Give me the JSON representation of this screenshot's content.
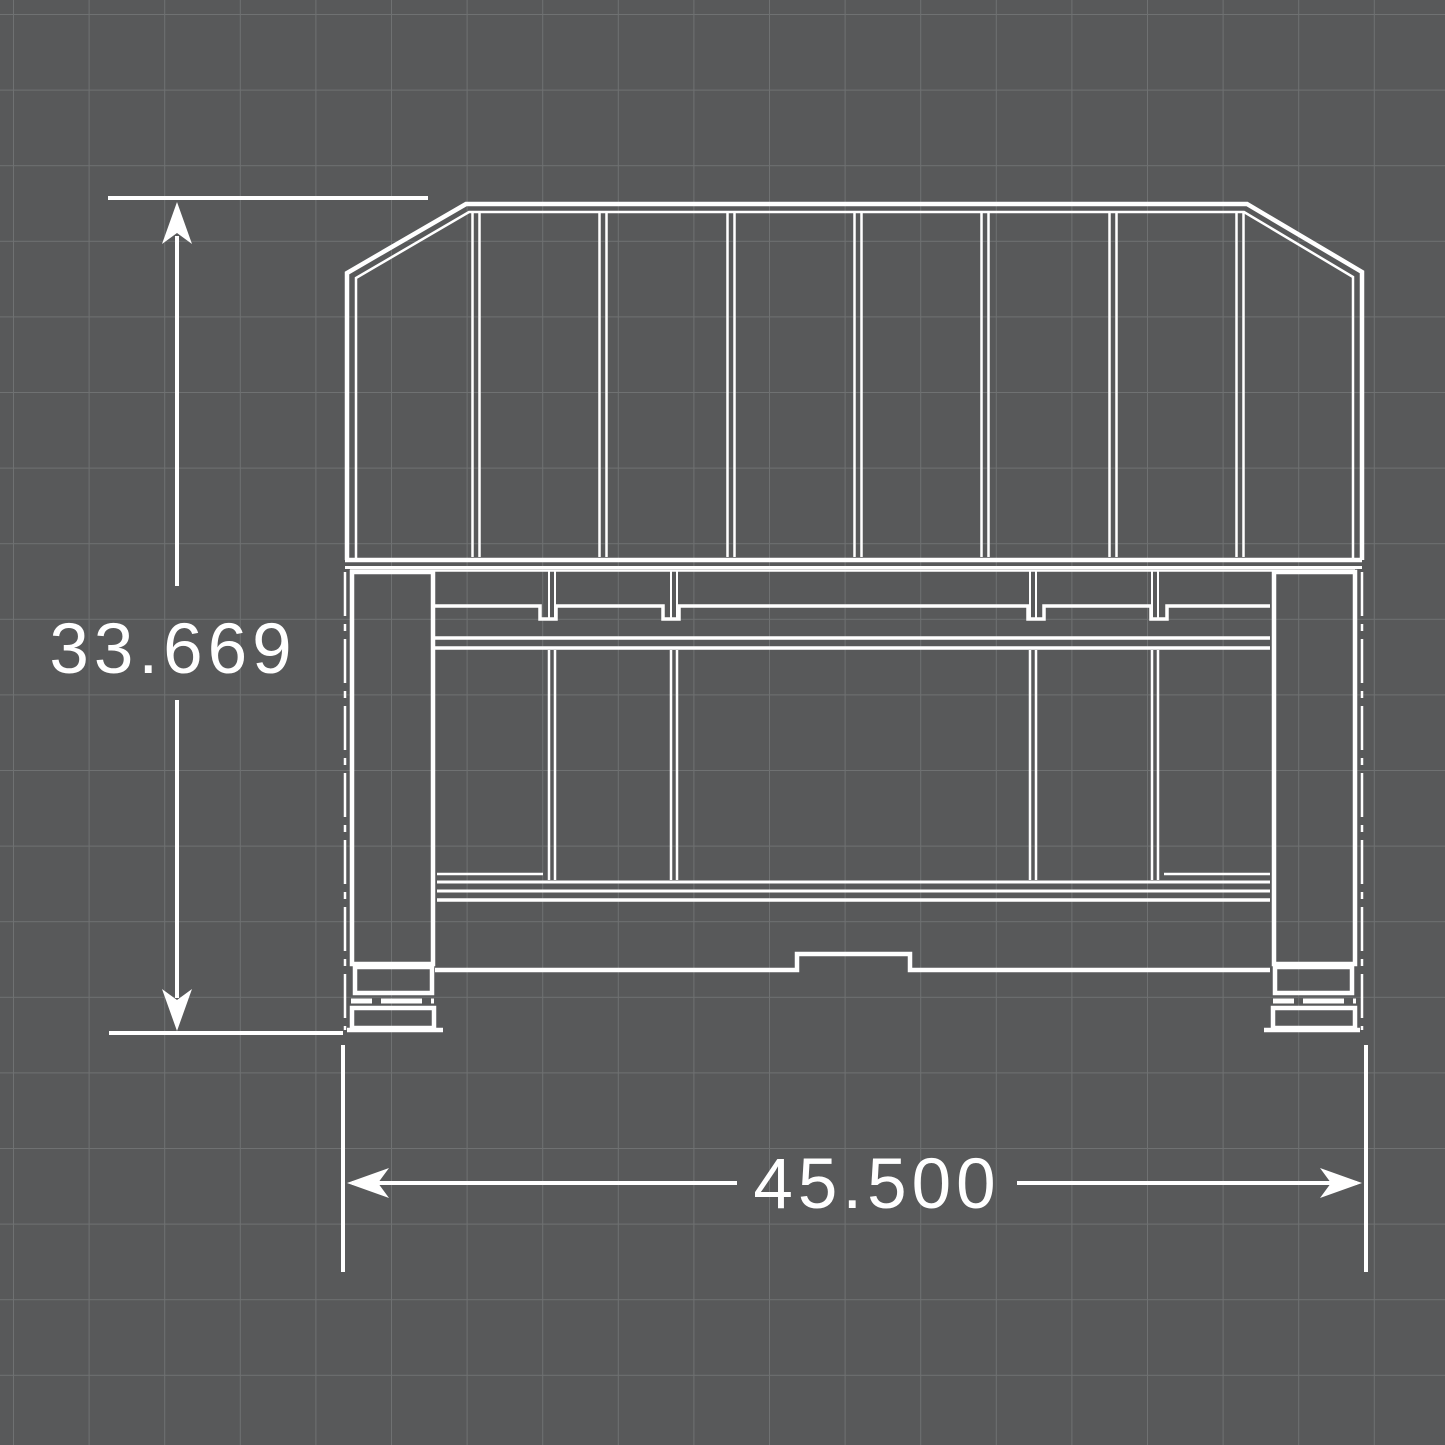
{
  "canvas": {
    "background": "#58595a",
    "grid_color": "#6f7172",
    "line_color": "#ffffff",
    "grid_spacing_px": 75.6
  },
  "dimensions": {
    "height": {
      "label": "33.669"
    },
    "width": {
      "label": "45.500"
    }
  }
}
